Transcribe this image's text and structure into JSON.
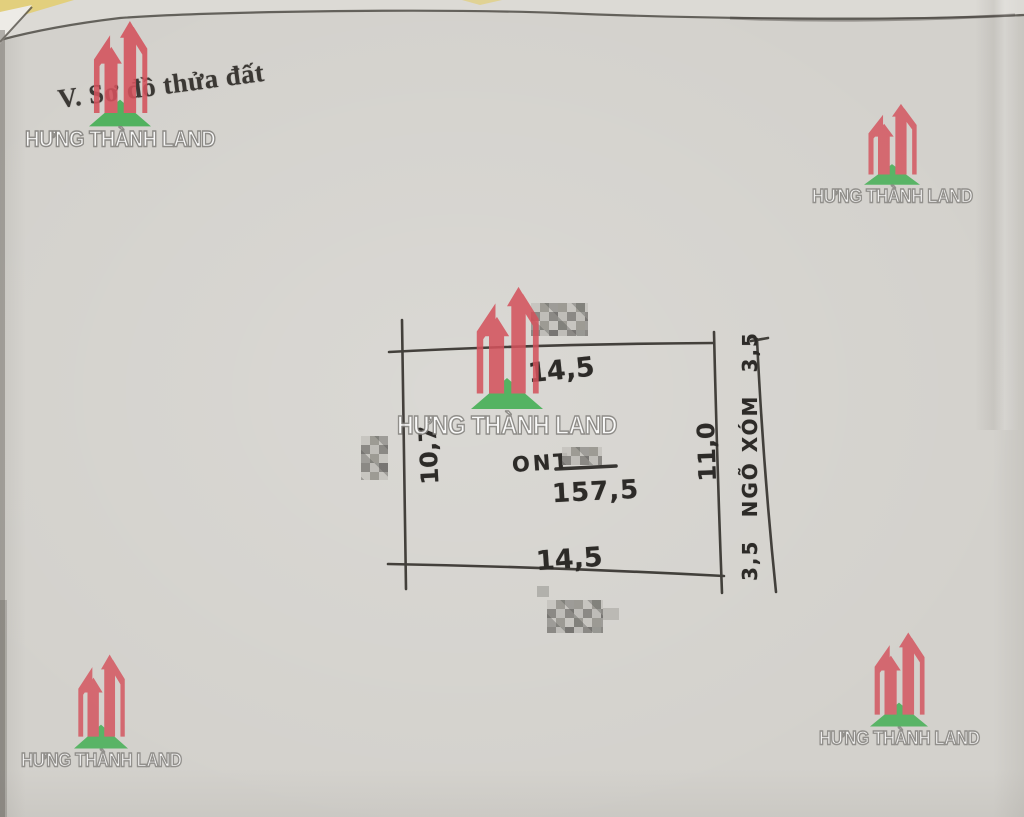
{
  "header": {
    "section_title": "V. Sơ đồ thửa đất"
  },
  "brand": {
    "name": "HƯNG THÀNH LAND",
    "logo_red": "#d4525c",
    "logo_green": "#3fae50"
  },
  "plot": {
    "edge_top": "14,5",
    "edge_bottom": "14,5",
    "edge_left": "10,7",
    "edge_right": "11,0",
    "land_type": "ONT",
    "area": "157,5",
    "alley_name": "NGÕ XÓM",
    "alley_width_upper": "3,5",
    "alley_width_lower": "3,5"
  }
}
